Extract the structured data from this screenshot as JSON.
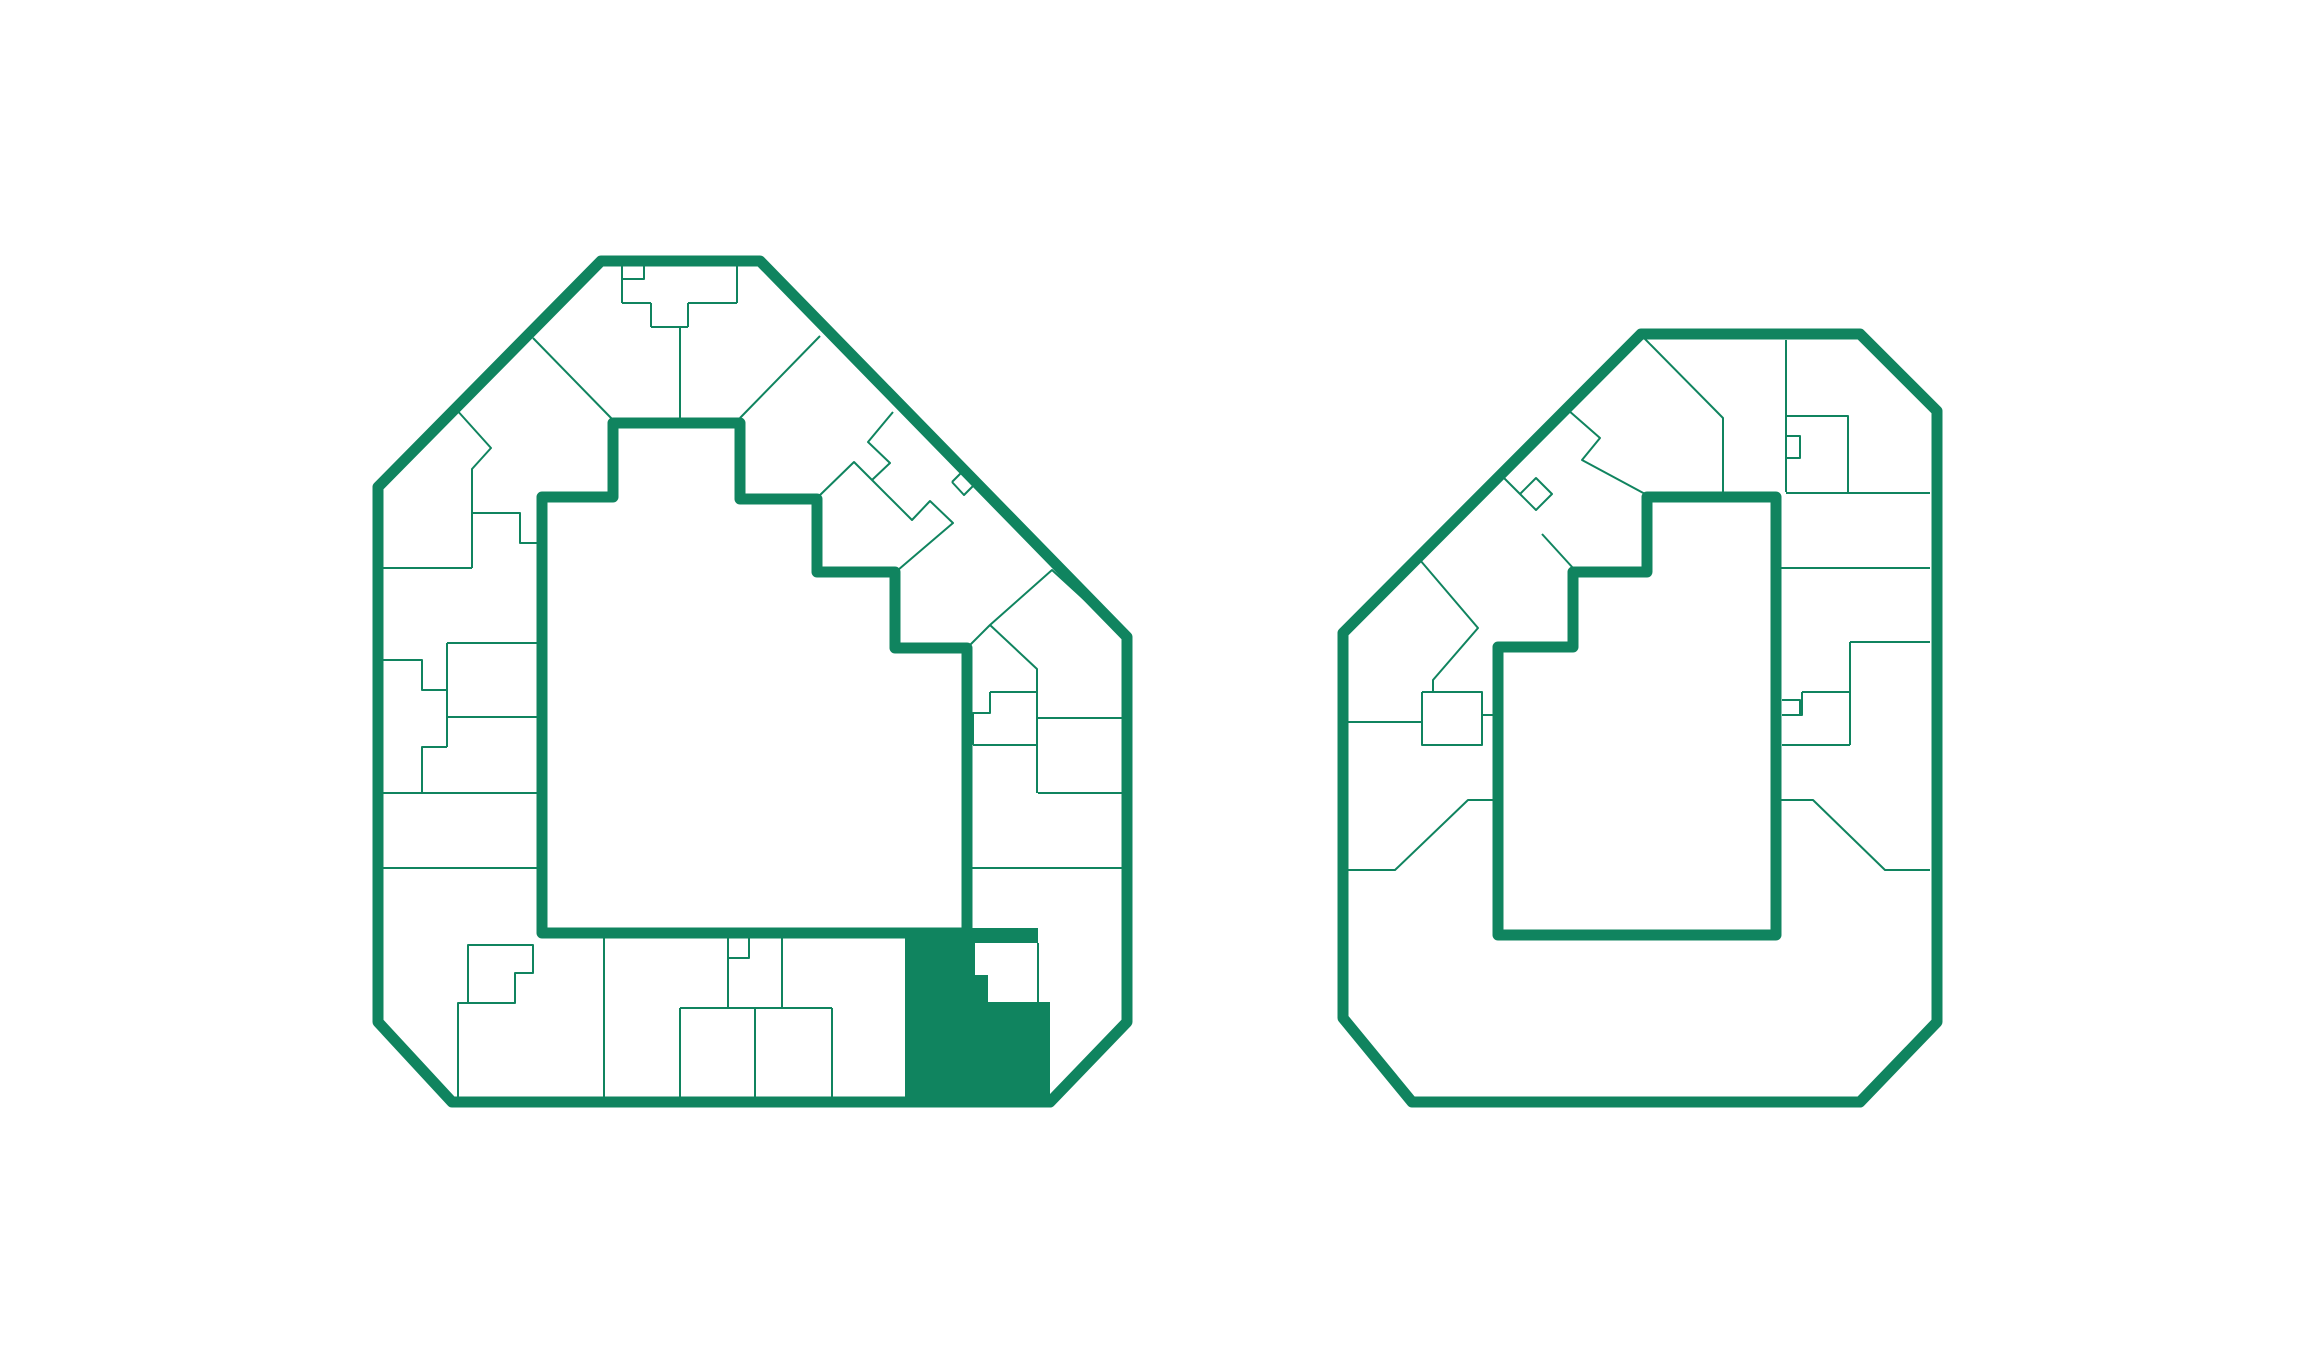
{
  "canvas": {
    "width": 2320,
    "height": 1360,
    "background": "#ffffff"
  },
  "colors": {
    "accent_green": "#10845F",
    "background": "#ffffff",
    "selected_unit_fill": "#10845F"
  },
  "stroke_widths": {
    "outer_wall": 11,
    "courtyard_wall": 11,
    "unit_divider": 2
  },
  "buildings": [
    {
      "name": "building-left-floorplan",
      "outline": [
        [
          601,
          261
        ],
        [
          760,
          261
        ],
        [
          1127,
          637
        ],
        [
          1127,
          1022
        ],
        [
          1050,
          1102
        ],
        [
          452,
          1102
        ],
        [
          378,
          1022
        ],
        [
          378,
          487
        ]
      ],
      "courtyard": [
        [
          613,
          423
        ],
        [
          740,
          423
        ],
        [
          740,
          499
        ],
        [
          817,
          499
        ],
        [
          817,
          572
        ],
        [
          895,
          572
        ],
        [
          895,
          648
        ],
        [
          967,
          648
        ],
        [
          967,
          933
        ],
        [
          542,
          933
        ],
        [
          542,
          497
        ],
        [
          613,
          497
        ]
      ],
      "selected_unit": [
        [
          905,
          928
        ],
        [
          1038,
          928
        ],
        [
          1038,
          943
        ],
        [
          975,
          943
        ],
        [
          975,
          975
        ],
        [
          988,
          975
        ],
        [
          988,
          1002
        ],
        [
          1050,
          1002
        ],
        [
          1050,
          1105
        ],
        [
          905,
          1105
        ]
      ],
      "unit_lines": [
        [
          [
            622,
            266
          ],
          [
            622,
            303
          ]
        ],
        [
          [
            622,
            303
          ],
          [
            651,
            303
          ]
        ],
        [
          [
            651,
            303
          ],
          [
            651,
            327
          ]
        ],
        [
          [
            651,
            327
          ],
          [
            688,
            327
          ]
        ],
        [
          [
            688,
            303
          ],
          [
            688,
            327
          ]
        ],
        [
          [
            688,
            303
          ],
          [
            737,
            303
          ]
        ],
        [
          [
            737,
            266
          ],
          [
            737,
            303
          ]
        ],
        [
          [
            623,
            279
          ],
          [
            644,
            279
          ],
          [
            644,
            266
          ]
        ],
        [
          [
            680,
            327
          ],
          [
            680,
            419
          ]
        ],
        [
          [
            533,
            338
          ],
          [
            613,
            420
          ]
        ],
        [
          [
            740,
            418
          ],
          [
            820,
            336
          ]
        ],
        [
          [
            455,
            408
          ],
          [
            491,
            448
          ],
          [
            472,
            469
          ],
          [
            472,
            568
          ]
        ],
        [
          [
            378,
            568
          ],
          [
            472,
            568
          ]
        ],
        [
          [
            472,
            513
          ],
          [
            520,
            513
          ],
          [
            520,
            543
          ],
          [
            537,
            543
          ]
        ],
        [
          [
            447,
            643
          ],
          [
            537,
            643
          ]
        ],
        [
          [
            447,
            643
          ],
          [
            447,
            747
          ]
        ],
        [
          [
            378,
            660
          ],
          [
            422,
            660
          ],
          [
            422,
            690
          ],
          [
            447,
            690
          ]
        ],
        [
          [
            447,
            717
          ],
          [
            537,
            717
          ]
        ],
        [
          [
            447,
            747
          ],
          [
            422,
            747
          ],
          [
            422,
            793
          ]
        ],
        [
          [
            381,
            793
          ],
          [
            537,
            793
          ]
        ],
        [
          [
            378,
            868
          ],
          [
            537,
            868
          ]
        ],
        [
          [
            468,
            1003
          ],
          [
            468,
            945
          ],
          [
            533,
            945
          ],
          [
            533,
            973
          ],
          [
            515,
            973
          ],
          [
            515,
            1003
          ],
          [
            458,
            1003
          ],
          [
            458,
            1102
          ]
        ],
        [
          [
            604,
            938
          ],
          [
            604,
            1102
          ]
        ],
        [
          [
            728,
            938
          ],
          [
            728,
            1008
          ]
        ],
        [
          [
            728,
            958
          ],
          [
            749,
            958
          ],
          [
            749,
            938
          ]
        ],
        [
          [
            782,
            938
          ],
          [
            782,
            1008
          ]
        ],
        [
          [
            680,
            1008
          ],
          [
            832,
            1008
          ]
        ],
        [
          [
            680,
            1008
          ],
          [
            680,
            1102
          ]
        ],
        [
          [
            755,
            1008
          ],
          [
            755,
            1102
          ]
        ],
        [
          [
            832,
            1008
          ],
          [
            832,
            1102
          ]
        ],
        [
          [
            893,
            412
          ],
          [
            868,
            442
          ],
          [
            890,
            463
          ],
          [
            872,
            480
          ]
        ],
        [
          [
            818,
            497
          ],
          [
            854,
            462
          ],
          [
            872,
            480
          ],
          [
            890,
            498
          ],
          [
            912,
            520
          ],
          [
            930,
            501
          ],
          [
            953,
            523
          ],
          [
            898,
            570
          ]
        ],
        [
          [
            952,
            482
          ],
          [
            964,
            470
          ],
          [
            976,
            483
          ],
          [
            964,
            495
          ],
          [
            952,
            482
          ]
        ],
        [
          [
            967,
            648
          ],
          [
            990,
            625
          ],
          [
            1052,
            570
          ],
          [
            1122,
            634
          ]
        ],
        [
          [
            990,
            625
          ],
          [
            1037,
            669
          ],
          [
            1037,
            793
          ]
        ],
        [
          [
            990,
            692
          ],
          [
            1037,
            692
          ]
        ],
        [
          [
            990,
            692
          ],
          [
            990,
            713
          ],
          [
            973,
            713
          ],
          [
            973,
            745
          ]
        ],
        [
          [
            973,
            745
          ],
          [
            1037,
            745
          ]
        ],
        [
          [
            1038,
            718
          ],
          [
            1125,
            718
          ]
        ],
        [
          [
            1038,
            793
          ],
          [
            1125,
            793
          ]
        ],
        [
          [
            970,
            868
          ],
          [
            1125,
            868
          ]
        ],
        [
          [
            1038,
            943
          ],
          [
            1038,
            1002
          ]
        ]
      ]
    },
    {
      "name": "building-right-floorplan",
      "outline": [
        [
          1641,
          334
        ],
        [
          1860,
          334
        ],
        [
          1937,
          411
        ],
        [
          1937,
          1022
        ],
        [
          1860,
          1102
        ],
        [
          1412,
          1102
        ],
        [
          1343,
          1018
        ],
        [
          1343,
          633
        ]
      ],
      "courtyard": [
        [
          1647,
          497
        ],
        [
          1776,
          497
        ],
        [
          1776,
          935
        ],
        [
          1498,
          935
        ],
        [
          1498,
          647
        ],
        [
          1573,
          647
        ],
        [
          1573,
          572
        ],
        [
          1647,
          572
        ]
      ],
      "selected_unit": null,
      "unit_lines": [
        [
          [
            1643,
            337
          ],
          [
            1723,
            418
          ],
          [
            1723,
            492
          ]
        ],
        [
          [
            1786,
            340
          ],
          [
            1786,
            492
          ]
        ],
        [
          [
            1786,
            416
          ],
          [
            1848,
            416
          ],
          [
            1848,
            493
          ]
        ],
        [
          [
            1786,
            493
          ],
          [
            1930,
            493
          ]
        ],
        [
          [
            1786,
            436
          ],
          [
            1800,
            436
          ],
          [
            1800,
            458
          ],
          [
            1786,
            458
          ]
        ],
        [
          [
            1568,
            410
          ],
          [
            1600,
            438
          ],
          [
            1582,
            460
          ],
          [
            1647,
            495
          ]
        ],
        [
          [
            1504,
            478
          ],
          [
            1520,
            494
          ],
          [
            1536,
            478
          ],
          [
            1552,
            494
          ],
          [
            1536,
            510
          ],
          [
            1520,
            494
          ]
        ],
        [
          [
            1542,
            534
          ],
          [
            1573,
            568
          ]
        ],
        [
          [
            1780,
            568
          ],
          [
            1930,
            568
          ]
        ],
        [
          [
            1850,
            642
          ],
          [
            1930,
            642
          ]
        ],
        [
          [
            1850,
            642
          ],
          [
            1850,
            745
          ]
        ],
        [
          [
            1802,
            692
          ],
          [
            1850,
            692
          ]
        ],
        [
          [
            1802,
            692
          ],
          [
            1802,
            715
          ],
          [
            1782,
            715
          ]
        ],
        [
          [
            1782,
            700
          ],
          [
            1800,
            700
          ],
          [
            1800,
            715
          ]
        ],
        [
          [
            1782,
            745
          ],
          [
            1850,
            745
          ]
        ],
        [
          [
            1776,
            800
          ],
          [
            1813,
            800
          ],
          [
            1885,
            870
          ],
          [
            1930,
            870
          ]
        ],
        [
          [
            1420,
            560
          ],
          [
            1478,
            628
          ],
          [
            1433,
            680
          ],
          [
            1433,
            692
          ]
        ],
        [
          [
            1422,
            692
          ],
          [
            1482,
            692
          ],
          [
            1482,
            745
          ],
          [
            1422,
            745
          ],
          [
            1422,
            692
          ]
        ],
        [
          [
            1482,
            715
          ],
          [
            1498,
            715
          ]
        ],
        [
          [
            1347,
            722
          ],
          [
            1422,
            722
          ]
        ],
        [
          [
            1498,
            800
          ],
          [
            1468,
            800
          ],
          [
            1395,
            870
          ],
          [
            1347,
            870
          ]
        ]
      ]
    }
  ]
}
